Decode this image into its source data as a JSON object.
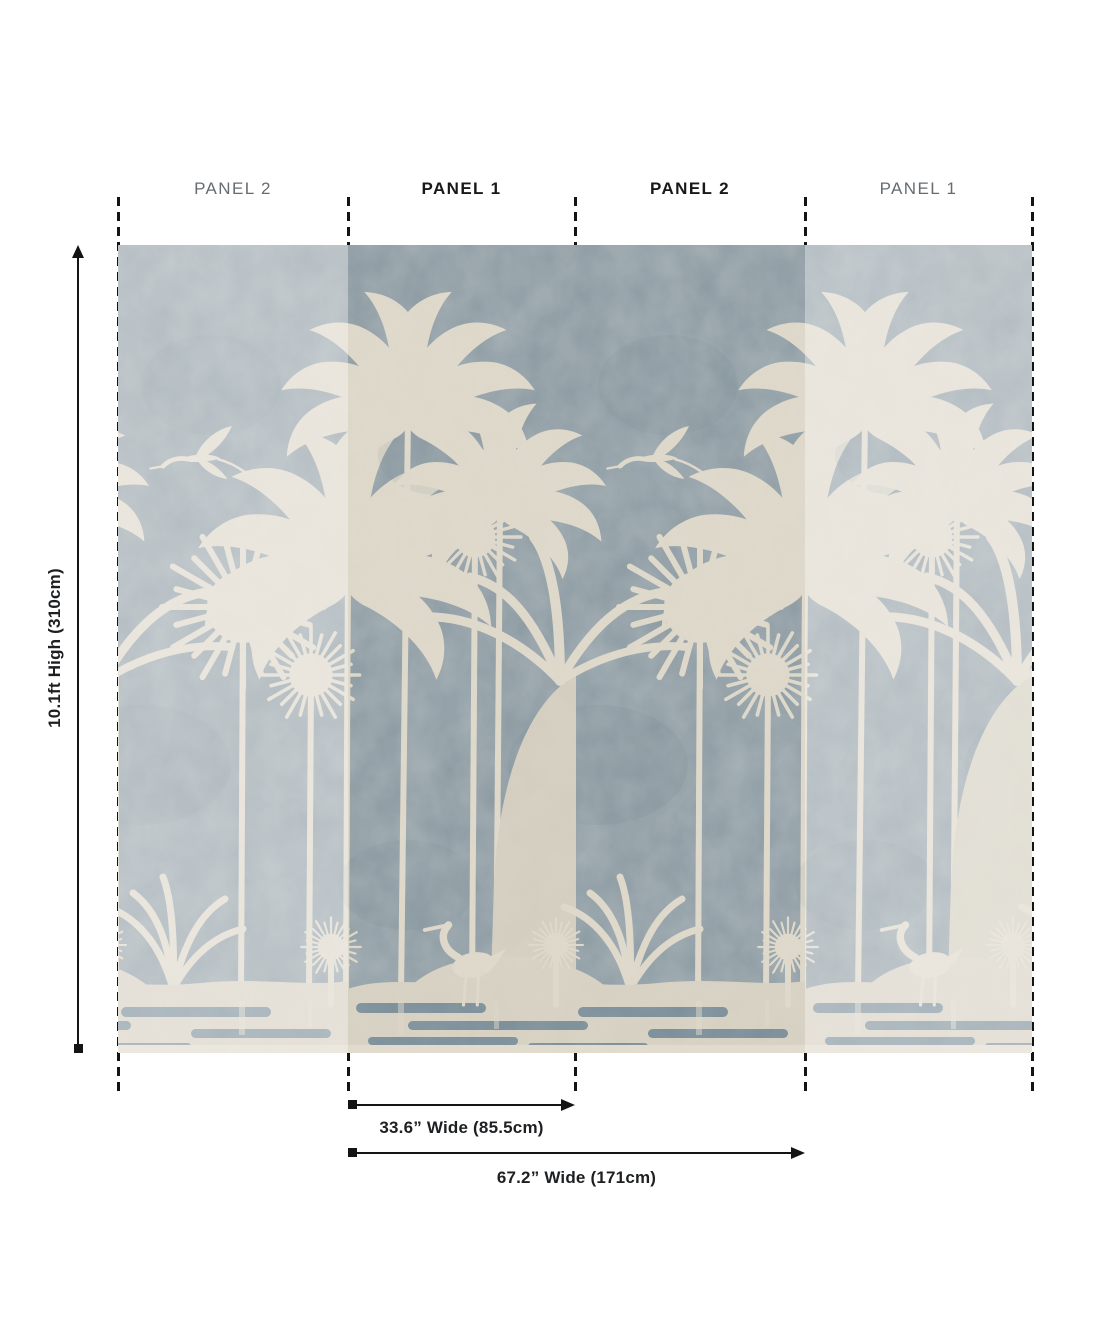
{
  "panel_labels": [
    {
      "label": "PANEL 2",
      "style": "muted"
    },
    {
      "label": "PANEL 1",
      "style": "bold"
    },
    {
      "label": "PANEL 2",
      "style": "bold"
    },
    {
      "label": "PANEL 1",
      "style": "muted"
    }
  ],
  "dimensions": {
    "height": "10.1ft High (310cm)",
    "panel_width": "33.6” Wide  (85.5cm)",
    "total_width": "67.2” Wide (171cm)"
  },
  "mural": {
    "description": "Palm trees and herons mural: cream silhouettes on mottled blue-grey plaster; outer repeat panels shown faded",
    "colors": {
      "bg": "#87959d",
      "palm": "#ddd7c9",
      "palmDim": "#d3cdbf",
      "sand": "#d6d0c2",
      "sandLight": "#e0dacc",
      "water": "#7b8e99",
      "blotch": "#5e717b",
      "overlay": "rgba(255,255,255,0.35)"
    }
  },
  "annotation": {
    "line_color": "#141414",
    "icons": {
      "panel_divider": "dashed-line",
      "height_dimension": "arrow-up-with-square-end",
      "width_dimension": "square-start-arrow-right"
    }
  }
}
